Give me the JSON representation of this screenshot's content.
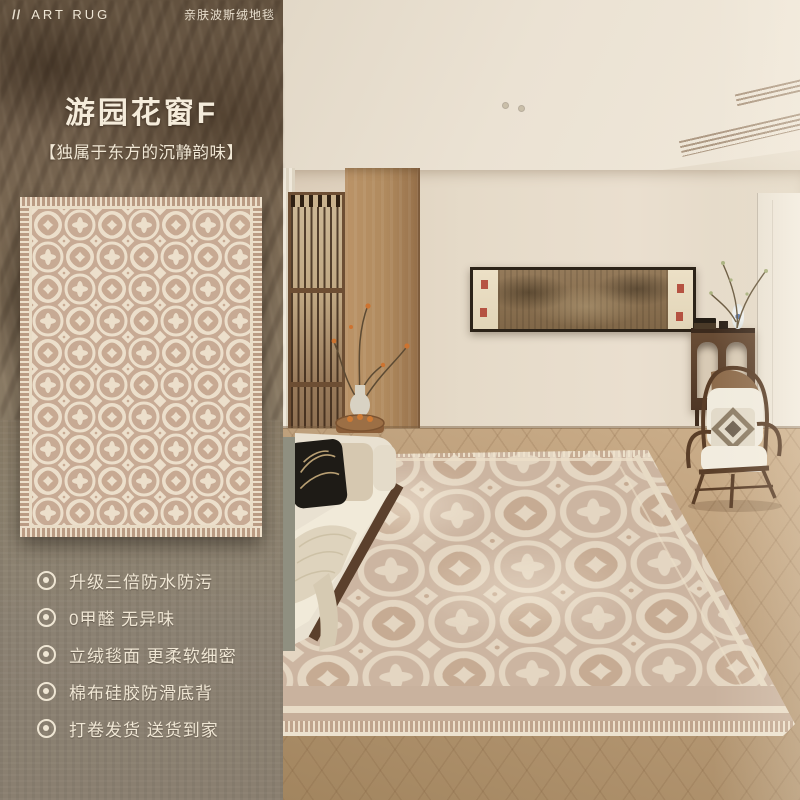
{
  "header": {
    "logo_prefix": "//",
    "brand": "ART RUG",
    "tagline": "亲肤波斯绒地毯"
  },
  "hero": {
    "title": "游园花窗F",
    "subtitle": "【独属于东方的沉静韵味】"
  },
  "features": {
    "bullet_icon": "double-circle",
    "items": [
      "升级三倍防水防污",
      "0甲醛 无异味",
      "立绒毯面 更柔软细密",
      "棉布硅胶防滑底背",
      "打卷发货 送货到家"
    ]
  },
  "colors": {
    "panel_text": "#f2e9d8",
    "panel_top": "#6a5846",
    "panel_bottom": "#8b8071",
    "rug_tan": "#c7aa94",
    "rug_cream": "#ecdfcb",
    "room_wall": "#e5dbca",
    "wood_floor": "#b29374",
    "seal_red": "#ad3b2b"
  }
}
